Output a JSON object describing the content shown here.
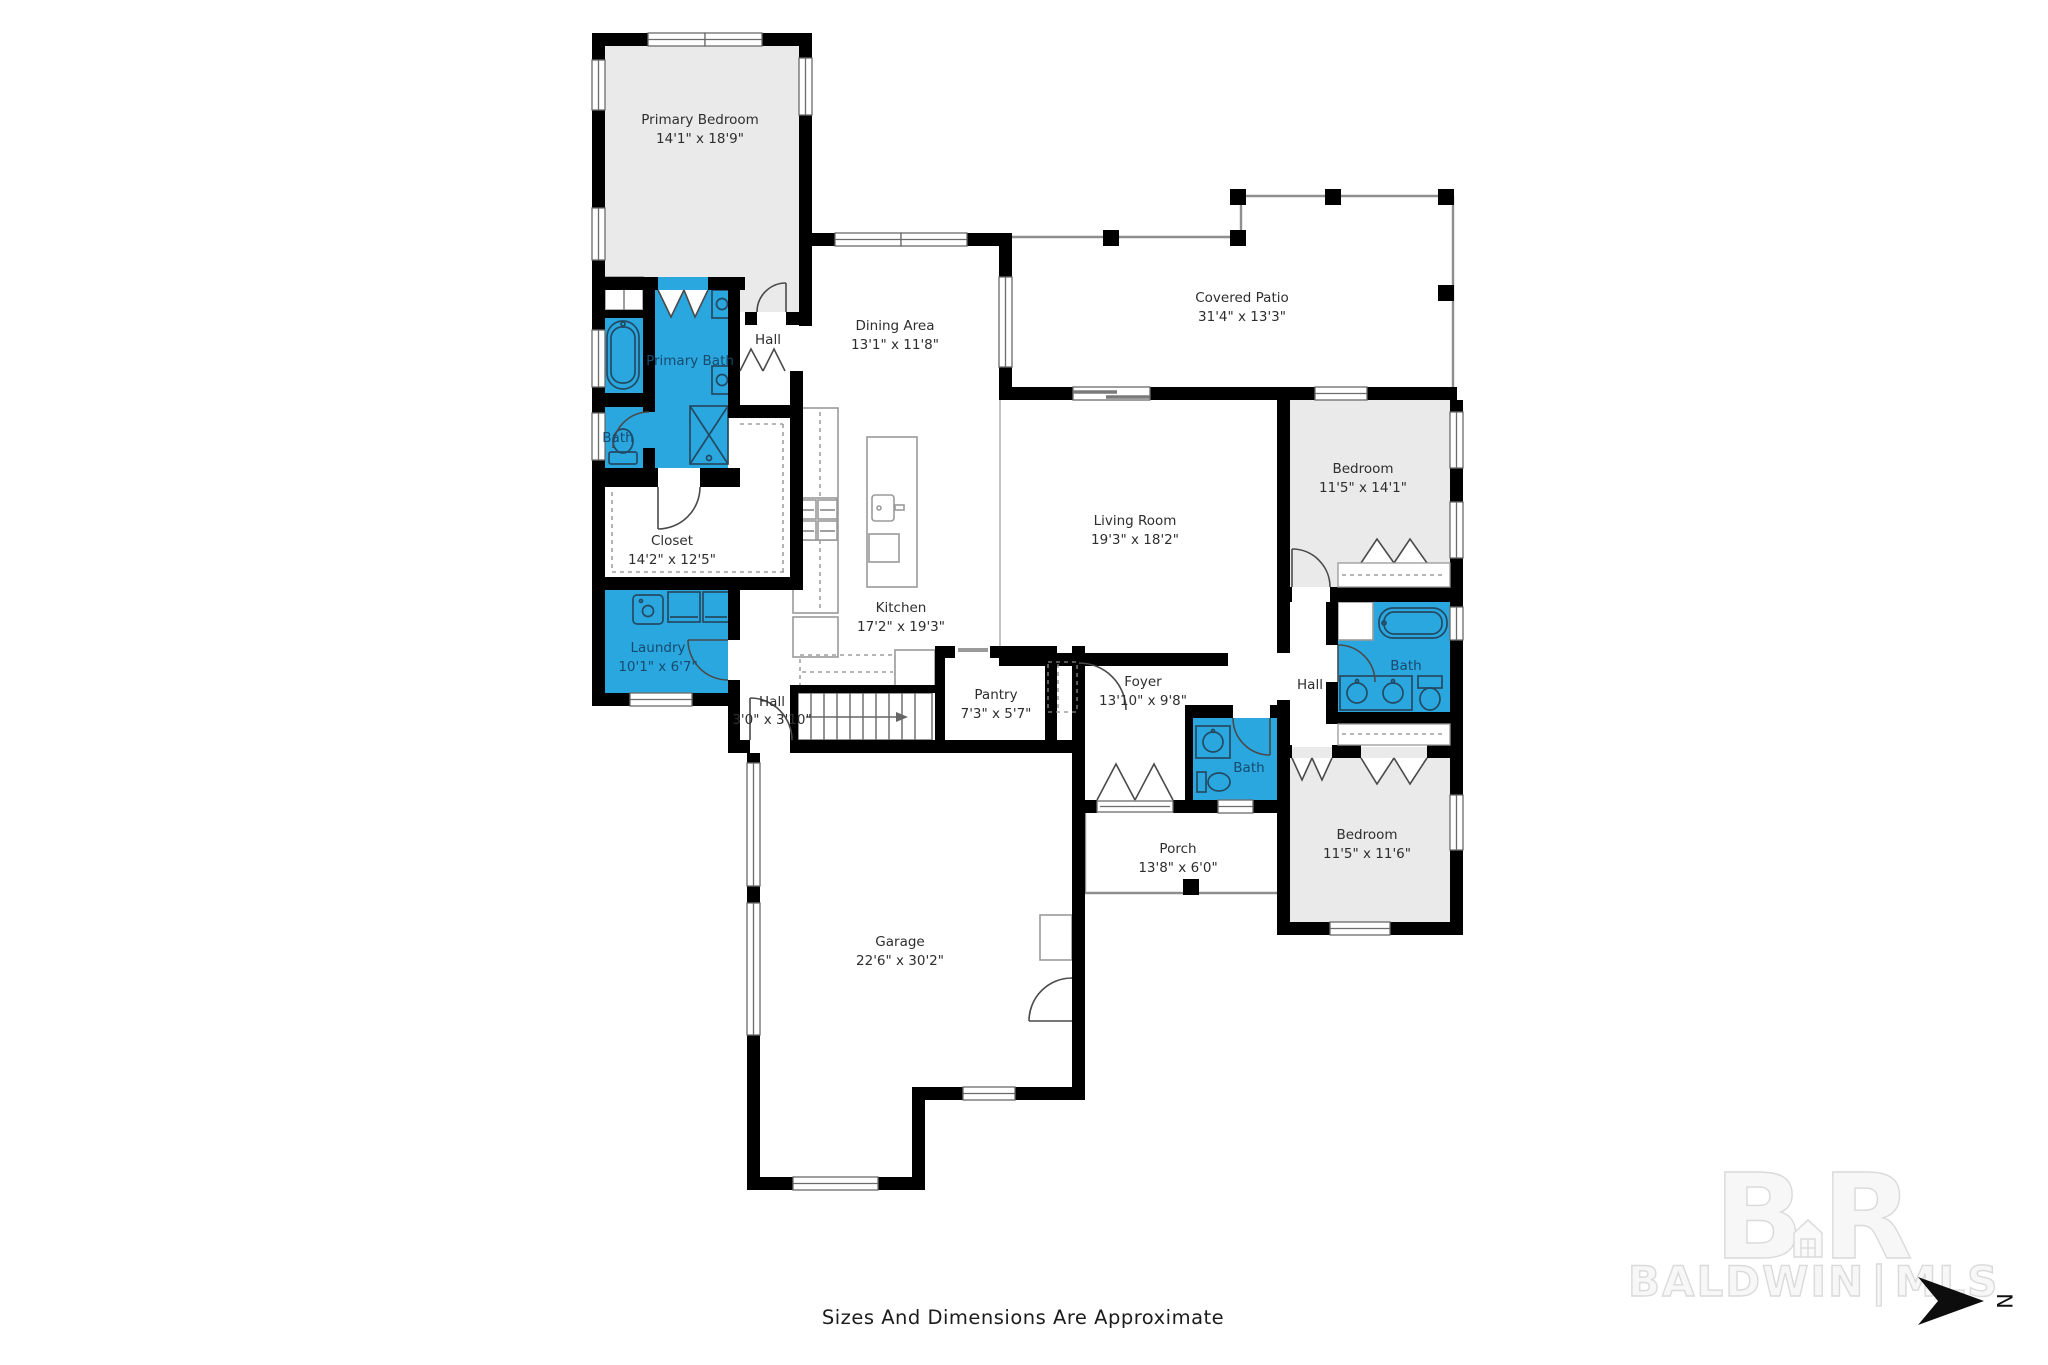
{
  "footer": {
    "note": "Sizes And Dimensions Are Approximate"
  },
  "watermark": {
    "initial_b": "B",
    "initial_r": "R",
    "brand_left": "BALDWIN",
    "separator": "|",
    "brand_right": "MLS"
  },
  "compass": {
    "north_label": "N"
  },
  "colors": {
    "wet_room_fill": "#2aa7de",
    "bedroom_fill": "#eaeaea",
    "wall": "#000000",
    "label_text": "#2e2e2e",
    "wet_label_text": "#174a6f",
    "watermark": "#dadada"
  },
  "rooms": {
    "primary_bedroom": {
      "name": "Primary Bedroom",
      "dims": "14'1\" x 18'9\""
    },
    "primary_bath": {
      "name": "Primary Bath"
    },
    "primary_wc": {
      "name": "Bath"
    },
    "hall_primary": {
      "name": "Hall"
    },
    "closet": {
      "name": "Closet",
      "dims": "14'2\" x 12'5\""
    },
    "laundry": {
      "name": "Laundry",
      "dims": "10'1\" x 6'7\""
    },
    "dining": {
      "name": "Dining Area",
      "dims": "13'1\" x 11'8\""
    },
    "kitchen": {
      "name": "Kitchen",
      "dims": "17'2\" x 19'3\""
    },
    "covered_patio": {
      "name": "Covered Patio",
      "dims": "31'4\" x 13'3\""
    },
    "living": {
      "name": "Living Room",
      "dims": "19'3\" x 18'2\""
    },
    "bedroom_2": {
      "name": "Bedroom",
      "dims": "11'5\" x 14'1\""
    },
    "hall_bedroom": {
      "name": "Hall"
    },
    "bath_shared": {
      "name": "Bath"
    },
    "hall_stairs": {
      "name": "Hall",
      "dims": "3'0\" x 3'10\""
    },
    "pantry": {
      "name": "Pantry",
      "dims": "7'3\" x 5'7\""
    },
    "foyer": {
      "name": "Foyer",
      "dims": "13'10\" x 9'8\""
    },
    "bath_foyer": {
      "name": "Bath"
    },
    "bedroom_3": {
      "name": "Bedroom",
      "dims": "11'5\" x 11'6\""
    },
    "porch": {
      "name": "Porch",
      "dims": "13'8\" x 6'0\""
    },
    "garage": {
      "name": "Garage",
      "dims": "22'6\" x 30'2\""
    }
  }
}
